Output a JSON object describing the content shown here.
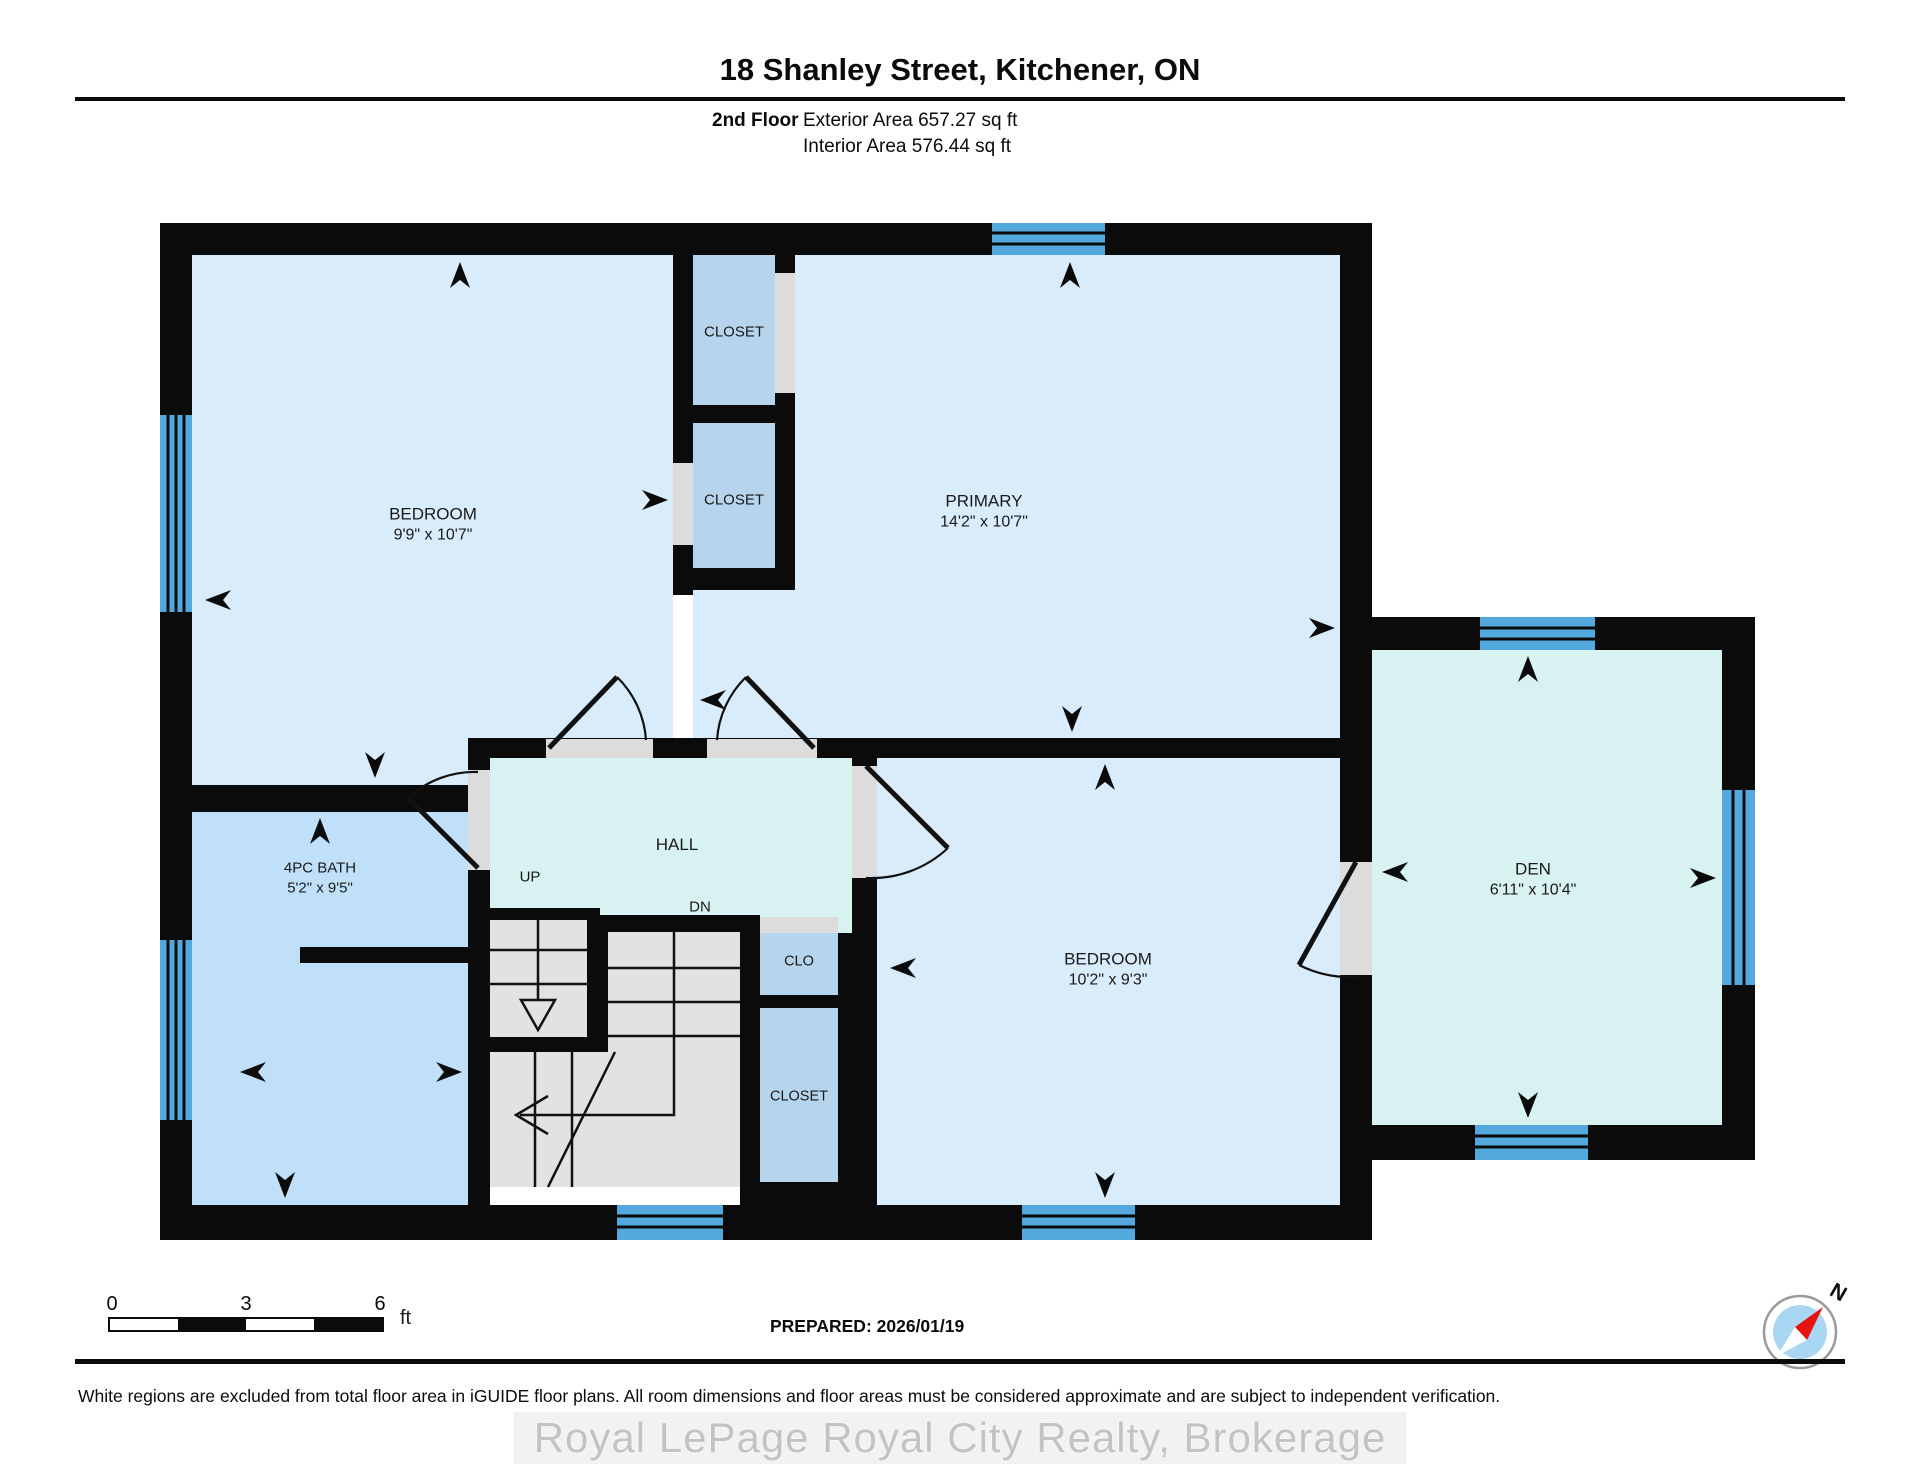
{
  "header": {
    "title": "18 Shanley Street, Kitchener, ON",
    "floor_label": "2nd Floor",
    "exterior_area": "Exterior Area 657.27 sq ft",
    "interior_area": "Interior Area 576.44 sq ft"
  },
  "rooms": {
    "bedroom1": {
      "name": "BEDROOM",
      "dims": "9'9\" x 10'7\""
    },
    "primary": {
      "name": "PRIMARY",
      "dims": "14'2\" x 10'7\""
    },
    "closet_top": {
      "name": "CLOSET"
    },
    "closet_mid": {
      "name": "CLOSET"
    },
    "bath": {
      "name": "4PC BATH",
      "dims": "5'2\" x 9'5\""
    },
    "hall": {
      "name": "HALL",
      "up_label": "UP",
      "dn_label": "DN"
    },
    "clo": {
      "name": "CLO"
    },
    "closet_bottom": {
      "name": "CLOSET"
    },
    "bedroom2": {
      "name": "BEDROOM",
      "dims": "10'2\" x 9'3\""
    },
    "den": {
      "name": "DEN",
      "dims": "6'11\" x 10'4\""
    }
  },
  "scale_bar": {
    "ticks": [
      "0",
      "3",
      "6"
    ],
    "unit": "ft"
  },
  "compass": {
    "north_label": "N"
  },
  "footer": {
    "prepared": "PREPARED: 2026/01/19",
    "disclaimer": "White regions are excluded from total floor area in iGUIDE floor plans. All room dimensions and floor areas must be considered approximate and are subject to independent verification.",
    "watermark": "Royal LePage Royal City Realty, Brokerage"
  },
  "colors": {
    "wall": "#0b0b0b",
    "room_light": "#d9ecfc",
    "room_medium": "#bfe0f8",
    "closet": "#b7d4ed",
    "hall": "#d8f1f1",
    "window": "#53a9dd",
    "stair": "#e2e2e2",
    "door": "#dcdcdc",
    "ink": "#1a1a1a"
  }
}
